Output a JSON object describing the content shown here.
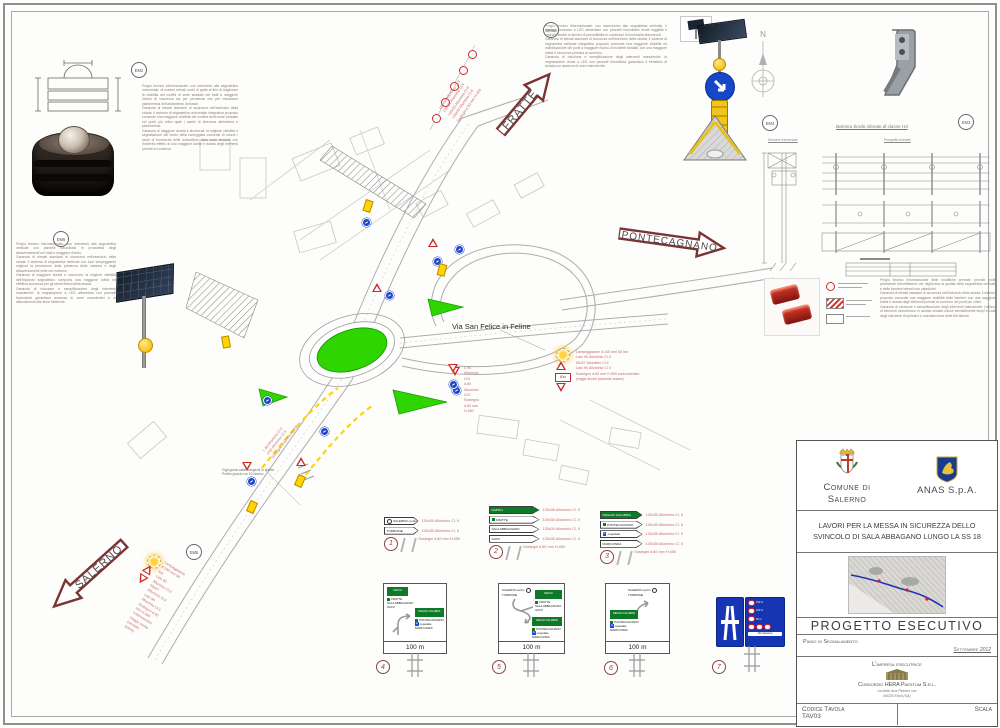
{
  "arrows": {
    "fratte": "FRATTE",
    "pontecagnano": "PONTECAGNANO",
    "salerno": "SALERNO"
  },
  "street": {
    "label": "Via San Felice in Feline"
  },
  "compass": {
    "north": "N"
  },
  "em_labels": {
    "em2": "EM2",
    "em6_left": "EM6",
    "em6_top": "EM6a",
    "em4": "EM4",
    "em3": "EM3",
    "em6_bottom": "EM6"
  },
  "notes": {
    "left_top": "Pregio tecnico informazionale: con intervento alla segnaletica orizzontale, di marker elevati occhi di gatto al fine di migliorare la visibilità dei confini di sede stradale nei tratti a maggiore rischio di sicurezza sia per pendenza che per variazione planimetrica dell'andamento dell'asse.\nGaranzia di elevati standard di sicurezza nell'esercizio della strada: il sistema di segnaletica orizzontale integrativa proposto consente una maggiore visibilità del confine della sede stradale nei punti più critici quali i cambi di direzione altimetrica e planimetrica.\nGaranzia di maggiore durata e sicurezza: la migliore visibilità e segnalazione del bordo della carreggiata consente di ridurre i rischi di fuoriuscita delle autovetture dalla sede stradale con l'indiretto effetto di una maggiore tutela e durata degli elementi previsti al contorno.",
    "left_column": "Pregio tecnico informazionale: con intervento alla segnaletica verticale con pannelli fotovoltaici in prossimità degli attraversamenti nei tratti a maggiore rischio.\nGaranzia di elevati standard di sicurezza nell'esercizio della strada: il sistema di segnaletica verticale con luce lampeggiante migliora la percezione della presenza della rotatoria e degli attraversamenti nelle ore notturne.\nGaranzia di maggiore durata e sicurezza: la migliore visibilità dell'impianto segnaletico comporta una maggiore tutela ed effettiva sicurezza per gli utenti deboli della strada.\nGaranzia di riduzione e semplificazione degli interventi manutentivi: la segnalazione a LED alimentata con pannelli fotovoltaici garantisce assenza di oneri manutentivi e di allacciamenti alle linee elettriche.",
    "top_center": "Pregio tecnico informazionale: con inserimento alla segnaletica verticale, il sistema luminoso a LED alimentato con pannelli fotovoltaici rende leggibile il segnale anche in termini di prevedibilità in condizioni di luminosità sfavorevoli.\nGaranzia di elevati standard di sicurezza nell'esercizio della strada: il sistema di segnaletica verticale integrativa proposto consente una maggiore visibilità ed individuazione dei punti a maggiore rischio di incidenti stradali, con una maggiore tutela e sicurezza prevista al contorno.\nGaranzia di riduzione e semplificazione degli interventi manutentivi: la segnalazione visiva a LED con pannelli fotovoltaici garantisce il beneficio di durata con assenza di oneri manutentivi.",
    "right_side": "Pregio tecnico informazionale delle modifiche previste: previsti profili perimetrali retroriflettenti che migliorano la qualità della segnaletica verticale e delle barriere laterali con catadiottri.\nGaranzia di elevati standard di sicurezza nell'esercizio della strada: il sistema proposto consente una maggiore visibilità delle barriere con una maggiore tutela e durata degli elementi previsti al contorno nei punti più critici.\nGaranzia di riduzione e semplificazione degli interventi manutentivi: l'utilizzo di elementi monoblocco in acciaio zincato riduce sensibilmente tempi e costi degli interventi di ripristino e manutenzione delle file laterali.",
    "ground_note": "Cigli guida catarifrangenti in resina\nProfilo guscio cm 10 bianco"
  },
  "callout_stacks": {
    "top_diagonal": "130x30 Alluminio Cl.II\n130x30 Alluminio Cl.II\n130x30 Alluminio Cl.II\n130x30 Alluminio Cl.II\nSostegni d.60 mm H.450",
    "flasher": "Lampeggiatore d.100 mm 60 led\nLato 90 Alluminio Cl.II\n50x27 Alluminio Cl.II\nLato 90 Alluminio Cl.II\nSostegno d.60 mm H.500 controventato\n(regge anche pannello solare)",
    "giveway": "L.90 Alluminio Cl.II\nd.60 Alluminio Cl.II\nSostegno d.60 mm H.450",
    "plate_text": "60m"
  },
  "barrier": {
    "title": "Barriera bordo rilevato di classe H3",
    "sec_label": "Sezione trasversale",
    "front_label": "Prospetto frontale"
  },
  "legend_items": {
    "spec": "130x30 Alluminio Cl. II",
    "support": "Sostegni d.60 mm H.450",
    "item1": {
      "num": "1",
      "signs": [
        {
          "t": "SALERNO centro"
        },
        {
          "t": "TORRIONE"
        }
      ]
    },
    "item2": {
      "num": "2",
      "signs": [
        {
          "t": "NAPOLI"
        },
        {
          "t": "FRATTE"
        },
        {
          "t": "SALA ABBAGNANO"
        },
        {
          "t": "GIOVI"
        }
      ]
    },
    "item3": {
      "num": "3",
      "signs": [
        {
          "t": "REGGIO CALABRIA"
        },
        {
          "t": "PONTECAGNANO"
        },
        {
          "t": "ospedale"
        },
        {
          "t": "MARICONDA"
        }
      ]
    }
  },
  "panels": {
    "distance": "100 m",
    "chip_napoli": "NAPOLI",
    "chip_reggio": "REGGIO CALABRIA",
    "p4": {
      "num": "4",
      "left_lines": [
        "FRATTE",
        "SALA ABBAGNANO",
        "GIOVI"
      ],
      "right_lines": [
        "PONTECAGNANO",
        "ospedale",
        "MARICONDA"
      ]
    },
    "p5": {
      "num": "5",
      "top_lines": [
        "SALERNO centro",
        "TORRIONE"
      ]
    },
    "p6": {
      "num": "6",
      "top_lines": [
        "SALERNO centro",
        "TORRIONE"
      ]
    },
    "p7": {
      "num": "7",
      "rows": [
        "150 m",
        "100 m",
        "50 m",
        "NO autostop"
      ]
    }
  },
  "titleblock": {
    "org_left": "Comune di Salerno",
    "org_right": "ANAS S.p.A.",
    "project_title": "LAVORI PER LA MESSA IN SICUREZZA DELLO SVINCOLO DI SALA ABBAGANO LUNGO LA SS 18",
    "stage": "PROGETTO ESECUTIVO",
    "doc_type": "Piano di Segnalamento",
    "date": "Settembre 2012",
    "contractor_label": "L'impresa esecutrice",
    "contractor_name": "Consorzio HERA Paestum S.r.l.",
    "contractor_addr1": "Località Isca Petraro snc",
    "contractor_addr2": "84025 Eboli (SA)",
    "code_label": "Codice Tavola",
    "code_value": "TAV03",
    "scale_label": "Scala"
  }
}
